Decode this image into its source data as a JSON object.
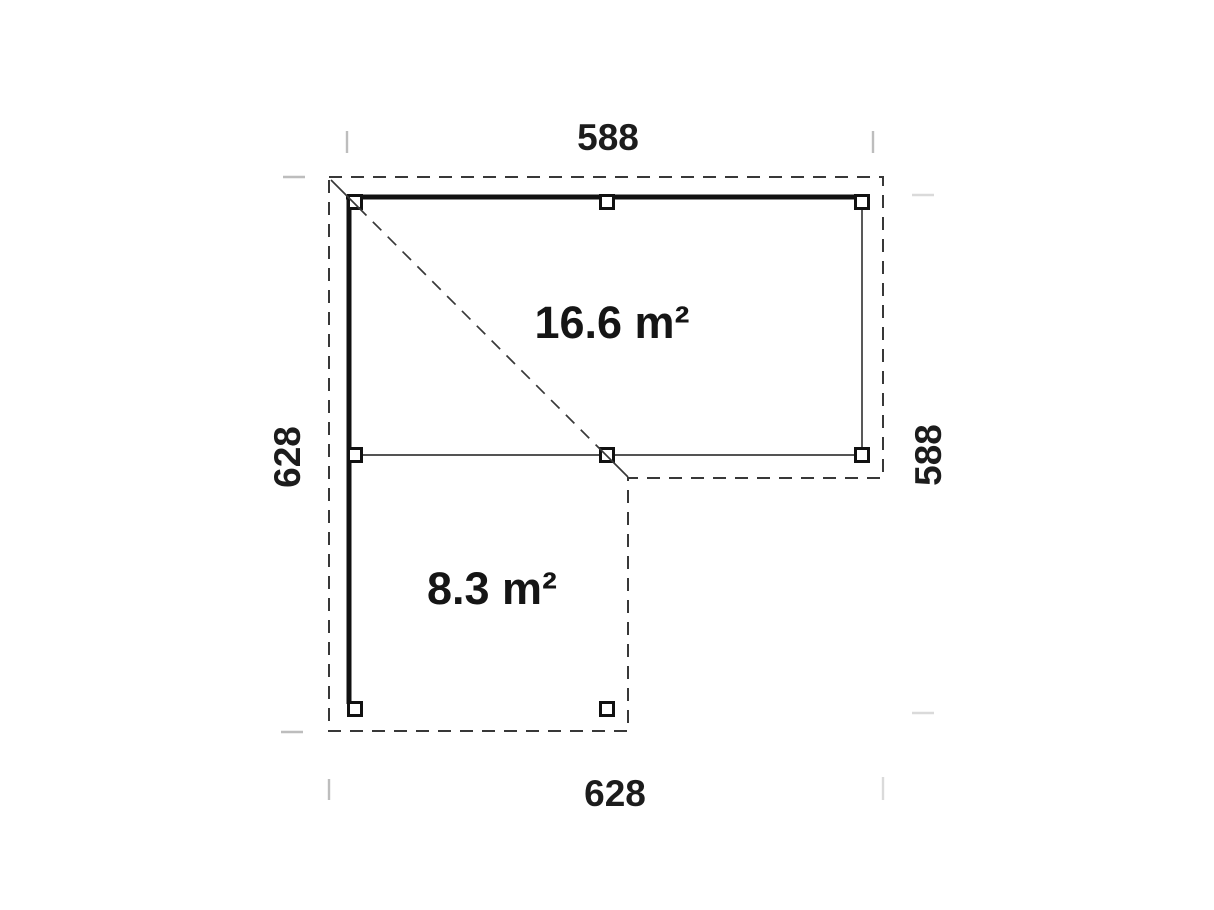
{
  "plan": {
    "dimensions": {
      "top": "588",
      "bottom": "628",
      "left": "628",
      "right": "588"
    },
    "areas": [
      {
        "label": "16.6 m²"
      },
      {
        "label": "8.3 m²"
      }
    ]
  }
}
